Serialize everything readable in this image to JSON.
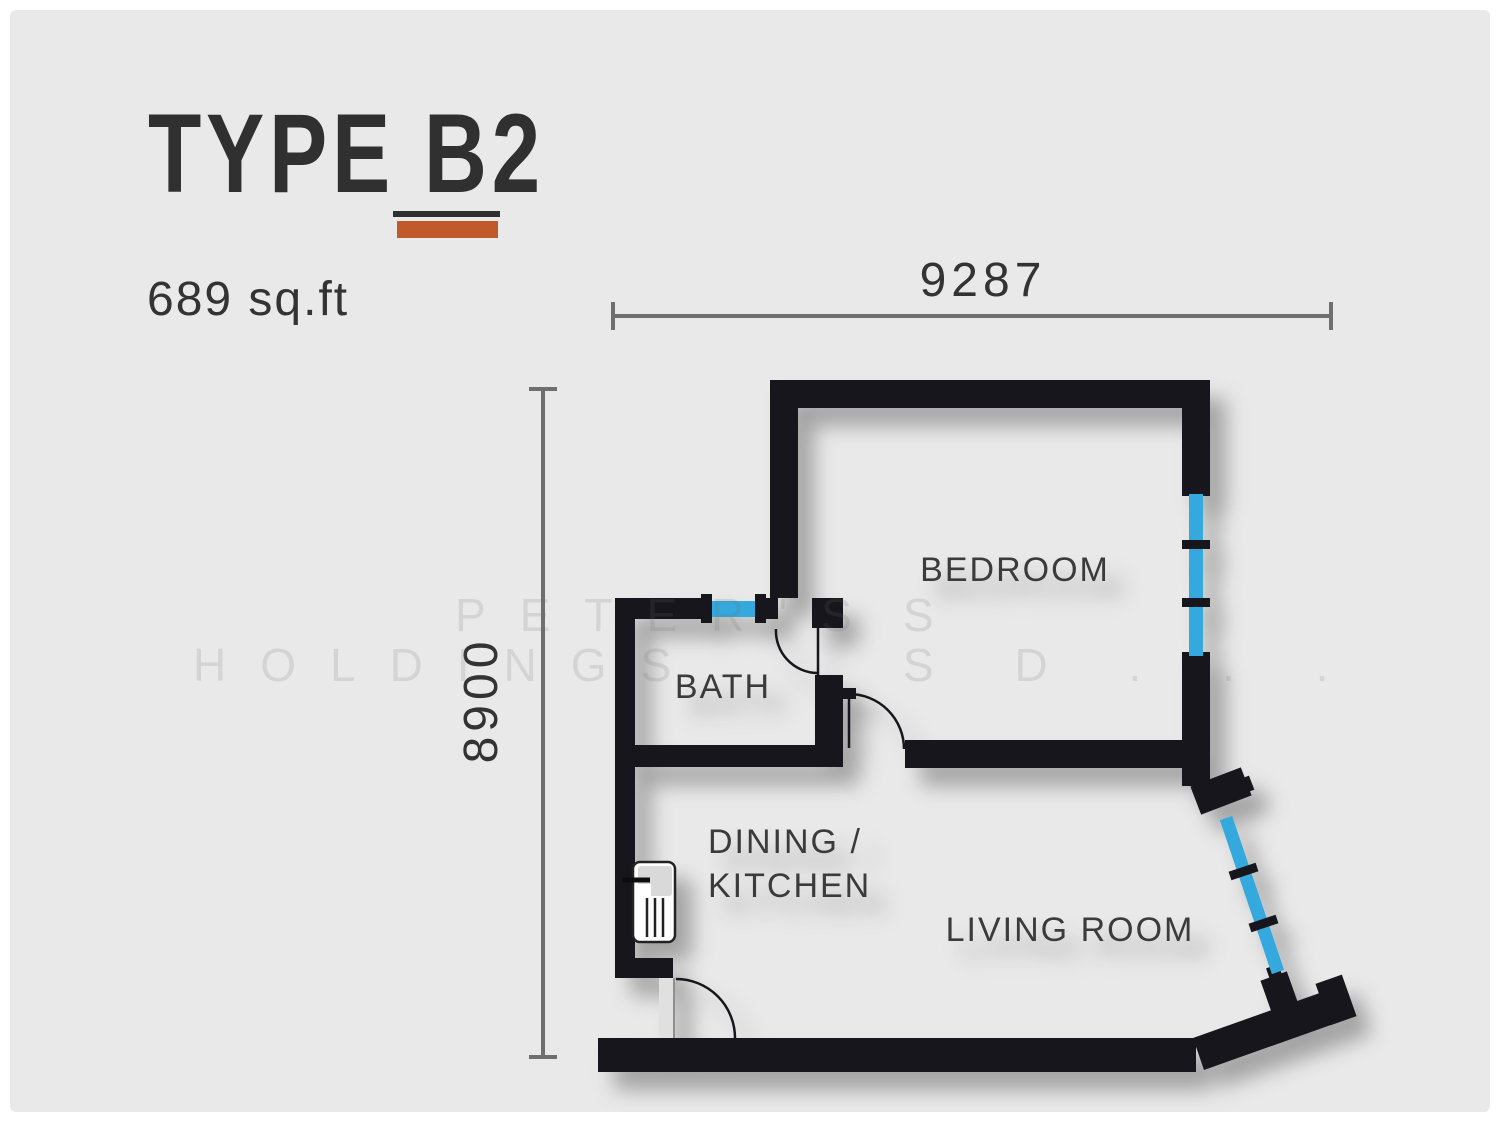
{
  "header": {
    "title": "TYPE B2",
    "area": "689 sq.ft"
  },
  "dimensions": {
    "top": "9287",
    "left": "8900"
  },
  "rooms": {
    "bedroom": "BEDROOM",
    "bath": "BATH",
    "dining_line1": "DINING /",
    "dining_line2": "KITCHEN",
    "living": "LIVING ROOM"
  },
  "watermark": {
    "line1": "PETER'S",
    "line1_frag": "S",
    "line2": "HOLDINGS",
    "line2_frag": "S D . . ."
  },
  "colors": {
    "accent_orange": "#c05a2b",
    "window_blue": "#35a8dd",
    "wall_black": "#17191c",
    "panel_bg": "#e9e9e9",
    "dimension_gray": "#6f6f6f",
    "label_gray": "#3a3a3a"
  }
}
